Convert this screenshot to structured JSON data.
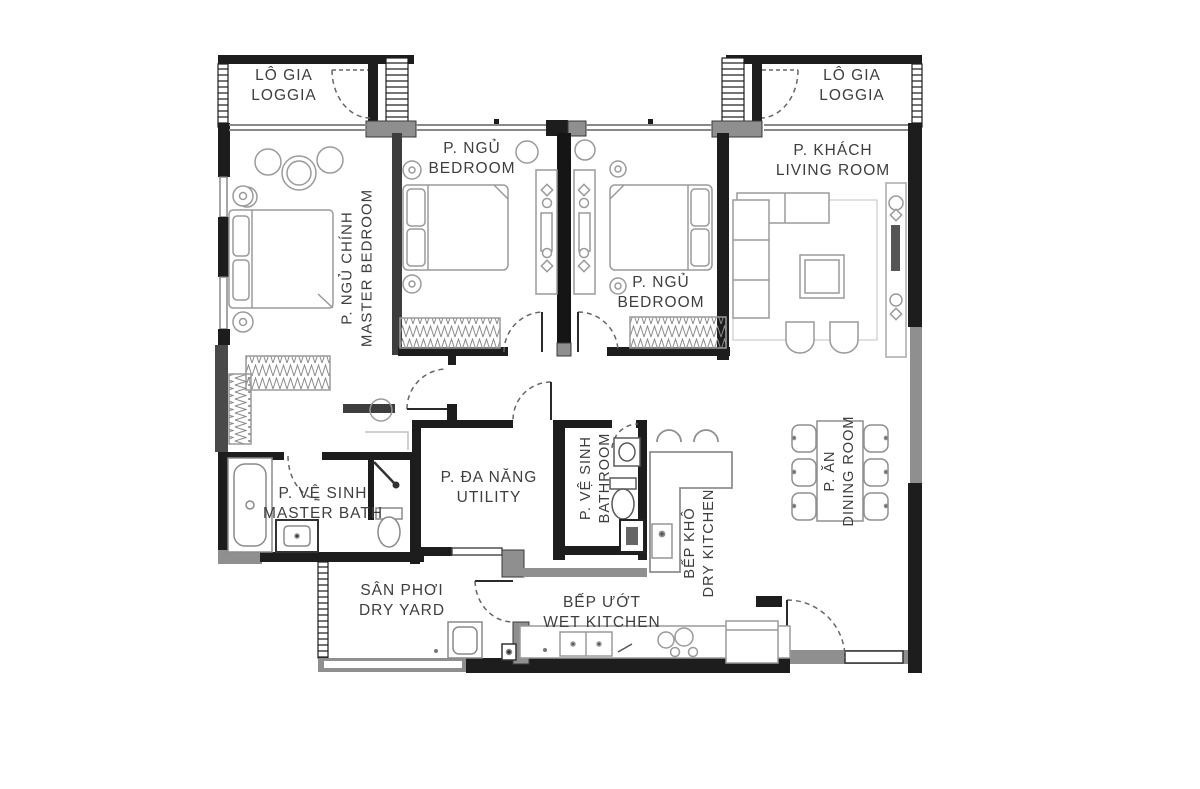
{
  "plan_title": "Apartment floor plan (3BR) with Vietnamese and English room labels",
  "rooms": {
    "loggia_left": {
      "vi": "LÔ GIA",
      "en": "LOGGIA"
    },
    "loggia_right": {
      "vi": "LÔ GIA",
      "en": "LOGGIA"
    },
    "bedroom1": {
      "vi": "P. NGỦ",
      "en": "BEDROOM"
    },
    "master_bedroom": {
      "vi": "P. NGỦ CHÍNH",
      "en": "MASTER BEDROOM"
    },
    "bedroom2": {
      "vi": "P. NGỦ",
      "en": "BEDROOM"
    },
    "living": {
      "vi": "P. KHÁCH",
      "en": "LIVING ROOM"
    },
    "utility": {
      "vi": "P. ĐA NĂNG",
      "en": "UTILITY"
    },
    "bathroom": {
      "vi": "P. VỆ SINH",
      "en": "BATHROOM"
    },
    "master_bath": {
      "vi": "P. VỆ SINH",
      "en": "MASTER BATH"
    },
    "dry_kitchen": {
      "vi": "BẾP KHÔ",
      "en": "DRY KITCHEN"
    },
    "dining": {
      "vi": "P. ĂN",
      "en": "DINING ROOM"
    },
    "dry_yard": {
      "vi": "SÂN PHƠI",
      "en": "DRY YARD"
    },
    "wet_kitchen": {
      "vi": "BẾP ƯỚT",
      "en": "WET KITCHEN"
    }
  },
  "colors": {
    "wall": "#1d1d1d",
    "wall_gray": "#8f8f8f",
    "wall_dark_gray": "#4a4a4a",
    "furniture_line": "#9a9a9a",
    "label_text": "#3e3e3e",
    "background": "#ffffff"
  }
}
